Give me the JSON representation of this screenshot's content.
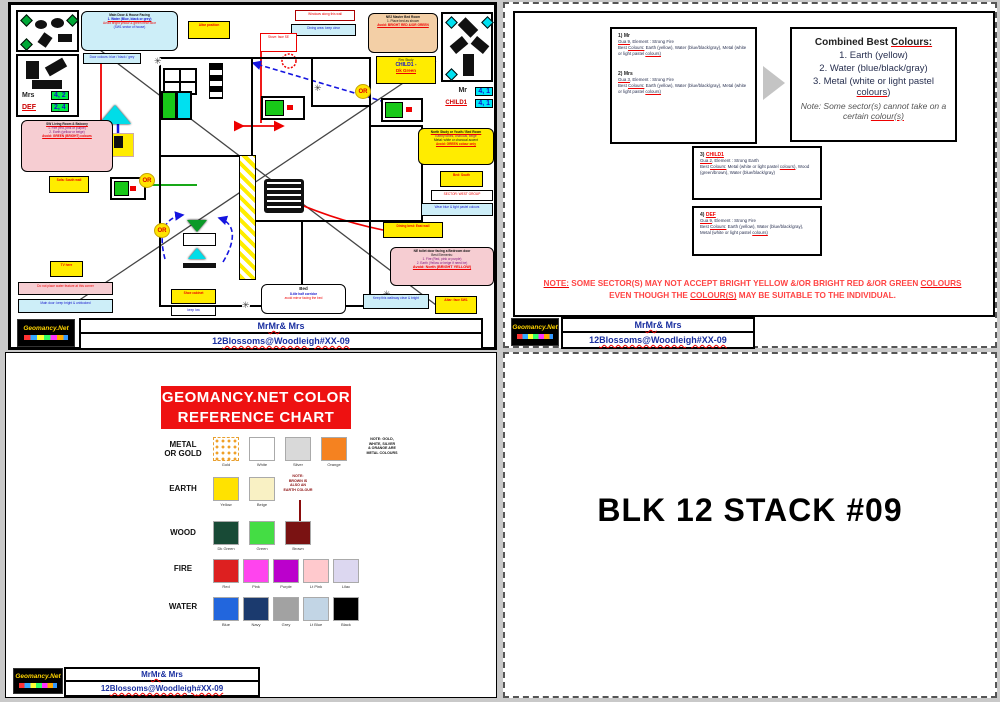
{
  "footer": {
    "l1a": "Mr ",
    "l1b": "Mr",
    "l1c": " & Mrs",
    "l2a": "12 ",
    "l2b": "Blossoms@Woodleigh",
    "l2c": " #XX-09",
    "logo": "Geomancy.Net"
  },
  "plan": {
    "or": "OR",
    "flower": "✳",
    "mrs": {
      "a": "Mrs",
      "av": "4, 2",
      "b": "DEF",
      "bv": "2, 4"
    },
    "mr": {
      "a": "Mr",
      "av": "4, 1",
      "b": "CHILD1",
      "bv": "4, 1"
    },
    "title": {
      "l1": "Main Door & House Facing",
      "l2": "1. Water (Blue, black or grey)",
      "l3": "Avoid bright yellow & green near door",
      "l4": "(SW1 sector of house)"
    },
    "cs1": "Door colours: blue / black / grey",
    "darkred": "Windows along this wall",
    "cyan2": "Dining area: keep clear",
    "redbox": "Stove: face SE",
    "yellow1": "Altar position",
    "peach": {
      "l1": "NE2 Master Bed Room",
      "l2": "1. Place bed as shown",
      "l3": "Avoid: BRIGHT RED &/OR GREEN"
    },
    "child": {
      "l1": "Rm: Study",
      "l2": "CHILD1 -",
      "l3": "Dk Green"
    },
    "yr1": {
      "l1": "North Study or Youth / Bed Room",
      "l2": "Earthy tones, charcoal, beige",
      "l3": "Metal: white or charcoal accent",
      "l4": "Avoid: GREEN colour only"
    },
    "yr2": "Bed: South",
    "wr": "SECTOR: WEST GROUP",
    "cr": "Wear blue & light pastel colours",
    "pinkne": {
      "l1": "NE toilet door facing a Bedroom door",
      "l2": "Best Elements:",
      "l3": "1. Fire (Red, pink or purple)",
      "l4": "2. Earth (Yellow or beige if need be)",
      "l5": "Avoid: North (BRIGHT YELLOW)"
    },
    "cyanb": "Keep this walkway clear & bright",
    "yellowb": "Altar: face SW1",
    "pinkl": {
      "l1": "SW Living Room & Balcony",
      "l2": "1. Fire (red, pink or purple)",
      "l3": "2. Earth (yellow or beige)",
      "l4": "Avoid: GREEN (BRIGHT) colours"
    },
    "yl1": "Sofa: South wall",
    "yl2": "TV here",
    "pstrip": "Do not place water feature at this corner",
    "cstrip": "Main door: keep bright & unblocked",
    "bedbox": {
      "l1": "Bed",
      "l2": "8-tile half corridor",
      "l3": "avoid mirror facing the bed"
    },
    "ymid": "Dining best: East wall",
    "ybc": "Shoe cabinet",
    "wbc": "keep low"
  },
  "colours_page": {
    "boxes": [
      {
        "nm_a": "1) Mr",
        "nm_b": "",
        "gua_a": "Gua 9",
        "gua_b": ", Element : Strong Fire",
        "b1": "Best ",
        "b2": "Colours:",
        "b3": " Earth (yellow), Water (blue/black/gray), Metal (white or light pastel ",
        "b4": "colours)",
        "b5": ""
      },
      {
        "nm_a": "2) Mrs",
        "nm_b": "",
        "gua_a": "Gua 3",
        "gua_b": ", Element : Strong Fire",
        "b1": "Best ",
        "b2": "Colours:",
        "b3": " Earth (yellow), Water (blue/black/gray), Metal (white or light pastel ",
        "b4": "colours)",
        "b5": ""
      },
      {
        "nm_a": "3) ",
        "nm_b": "CHILD1",
        "gua_a": "Gua 2",
        "gua_b": ", Element : Strong Earth",
        "b1": "Best ",
        "b2": "Colours:",
        "b3": " Metal (white or light pastel ",
        "b4": "colours)",
        "b5": ", Wood (green/brown), Water (blue/black/gray)"
      },
      {
        "nm_a": "4) ",
        "nm_b": "DEF",
        "gua_a": "Gua 9",
        "gua_b": ", Element : Strong Fire",
        "b1": "Best ",
        "b2": "Colours:",
        "b3": " Earth (yellow), Water (blue/black/gray), Metal (white or light pastel ",
        "b4": "colours)",
        "b5": ""
      }
    ],
    "combined": {
      "t_a": "Combined Best ",
      "t_b": "Colours:",
      "i1": "1. Earth (yellow)",
      "i2": "2. Water (blue/black/gray)",
      "i3_a": "3. Metal (white or light pastel ",
      "i3_b": "colours",
      "i3_c": ")",
      "n_a": "Note: Some sector(s) cannot take on a certain ",
      "n_b": "colour(s)"
    },
    "note": {
      "n1": "NOTE:",
      "n2": " SOME SECTOR(S) MAY NOT ACCEPT BRIGHT YELLOW &/OR BRIGHT RED &/OR GREEN ",
      "n3": "COLOURS",
      "m1": "EVEN THOUGH THE ",
      "m2": "COLOUR(S)",
      "m3": " MAY BE SUITABLE TO THE INDIVIDUAL."
    }
  },
  "chart": {
    "title1": "GEOMANCY.NET COLOR",
    "title2": "REFERENCE CHART",
    "rows": [
      {
        "label": "METAL\nOR GOLD",
        "swatches": [
          {
            "name": "Gold",
            "hex": ""
          },
          {
            "name": "White",
            "hex": "#ffffff"
          },
          {
            "name": "Silver",
            "hex": "#d9d9d9"
          },
          {
            "name": "Orange",
            "hex": "#f58220"
          }
        ]
      },
      {
        "label": "EARTH",
        "swatches": [
          {
            "name": "Yellow",
            "hex": "#ffe200"
          },
          {
            "name": "Beige",
            "hex": "#f9f1c4"
          }
        ]
      },
      {
        "label": "WOOD",
        "swatches": [
          {
            "name": "Dk Green",
            "hex": "#184a36"
          },
          {
            "name": "Green",
            "hex": "#44dd44"
          },
          {
            "name": "Brown",
            "hex": "#7a1212"
          }
        ]
      },
      {
        "label": "FIRE",
        "swatches": [
          {
            "name": "Red",
            "hex": "#dd2020"
          },
          {
            "name": "Pink",
            "hex": "#ff44ee"
          },
          {
            "name": "Purple",
            "hex": "#bb00cc"
          },
          {
            "name": "Lt Pink",
            "hex": "#ffc9cd"
          },
          {
            "name": "Lilac",
            "hex": "#dcd7f0"
          }
        ]
      },
      {
        "label": "WATER",
        "swatches": [
          {
            "name": "Blue",
            "hex": "#2266dd"
          },
          {
            "name": "Navy",
            "hex": "#1b3a6e"
          },
          {
            "name": "Grey",
            "hex": "#a2a2a2"
          },
          {
            "name": "Lt Blue",
            "hex": "#c2d5e5"
          },
          {
            "name": "Black",
            "hex": "#000000"
          }
        ]
      }
    ],
    "metal_note": "NOTE: GOLD,\nWHITE, SILVER\n& ORANGE ARE\nMETAL COLOURS",
    "earth_note": "NOTE:\nBROWN IS\nALSO AN\nEARTH COLOUR"
  },
  "stack_page": {
    "title": "BLK 12 STACK #09"
  }
}
